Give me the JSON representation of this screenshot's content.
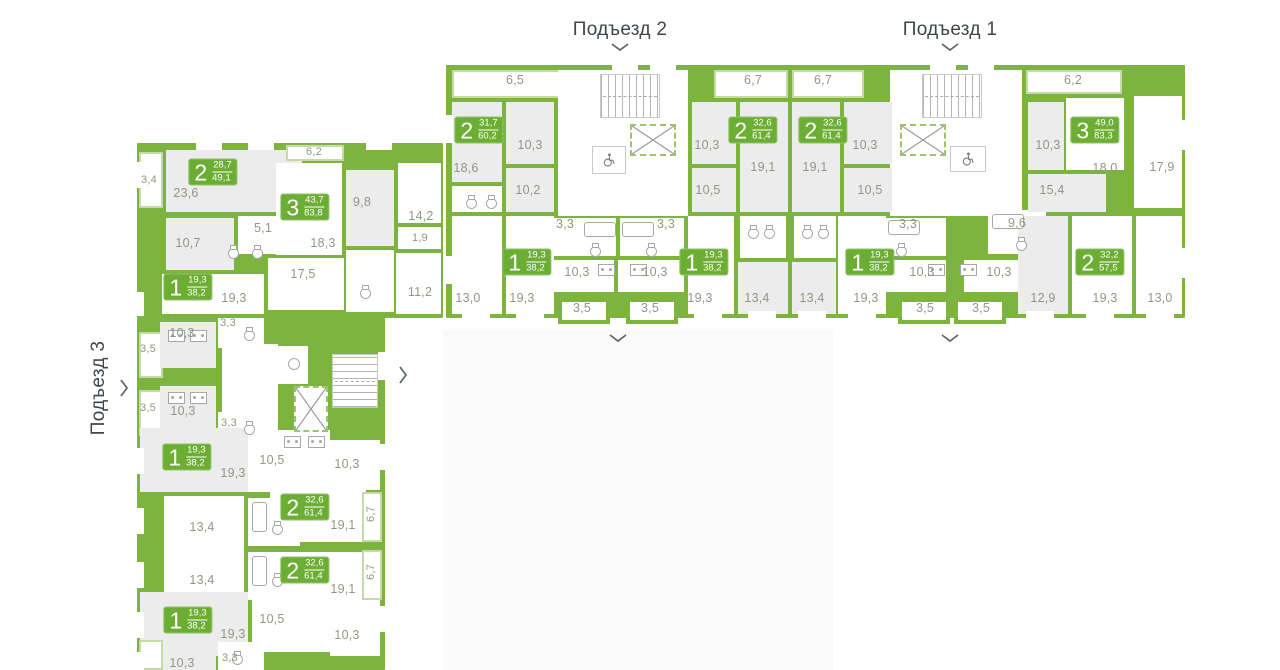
{
  "title": "Floor plan with entrances",
  "colors": {
    "wall": "#7db440",
    "badge": "#6cae34",
    "room_gray": "#ececec",
    "room_white": "#ffffff",
    "balcony_border": "#c6daa5",
    "area_label": "#8f9884",
    "entrance_label": "#3f474a"
  },
  "entrances": [
    {
      "label": "Подъезд 2",
      "x": 620,
      "y": 30,
      "rotated": false,
      "chevrons": [
        {
          "x": 620,
          "y": 47,
          "dir": "down"
        },
        {
          "x": 618,
          "y": 338,
          "dir": "down"
        }
      ]
    },
    {
      "label": "Подъезд 1",
      "x": 950,
      "y": 30,
      "rotated": false,
      "chevrons": [
        {
          "x": 950,
          "y": 47,
          "dir": "down"
        },
        {
          "x": 950,
          "y": 338,
          "dir": "down"
        }
      ]
    },
    {
      "label": "Подъезд 3",
      "x": 99,
      "y": 388,
      "rotated": true,
      "chevrons": [
        {
          "x": 124,
          "y": 388,
          "dir": "right"
        },
        {
          "x": 403,
          "y": 375,
          "dir": "right"
        }
      ]
    }
  ],
  "apartment_badges": [
    {
      "rooms": "2",
      "living": "31,7",
      "total": "60,2",
      "x": 479,
      "y": 130
    },
    {
      "rooms": "1",
      "living": "19,3",
      "total": "38,2",
      "x": 527,
      "y": 262
    },
    {
      "rooms": "1",
      "living": "19,3",
      "total": "38,2",
      "x": 704,
      "y": 262
    },
    {
      "rooms": "2",
      "living": "32,6",
      "total": "61,4",
      "x": 753,
      "y": 130
    },
    {
      "rooms": "2",
      "living": "32,6",
      "total": "61,4",
      "x": 823,
      "y": 130
    },
    {
      "rooms": "1",
      "living": "19,3",
      "total": "38,2",
      "x": 870,
      "y": 262
    },
    {
      "rooms": "3",
      "living": "49,0",
      "total": "83,3",
      "x": 1095,
      "y": 130
    },
    {
      "rooms": "2",
      "living": "32,2",
      "total": "57,5",
      "x": 1100,
      "y": 262
    },
    {
      "rooms": "2",
      "living": "28,7",
      "total": "49,1",
      "x": 213,
      "y": 172
    },
    {
      "rooms": "3",
      "living": "43,7",
      "total": "83,8",
      "x": 305,
      "y": 207
    },
    {
      "rooms": "1",
      "living": "19,3",
      "total": "38,2",
      "x": 188,
      "y": 287
    },
    {
      "rooms": "1",
      "living": "19,3",
      "total": "38,2",
      "x": 187,
      "y": 457
    },
    {
      "rooms": "2",
      "living": "32,6",
      "total": "61,4",
      "x": 305,
      "y": 507
    },
    {
      "rooms": "2",
      "living": "32,6",
      "total": "61,4",
      "x": 305,
      "y": 570
    },
    {
      "rooms": "1",
      "living": "19,3",
      "total": "38,2",
      "x": 188,
      "y": 620
    }
  ],
  "area_labels": [
    {
      "text": "6,5",
      "x": 515,
      "y": 80
    },
    {
      "text": "6,7",
      "x": 753,
      "y": 80
    },
    {
      "text": "6,7",
      "x": 823,
      "y": 80
    },
    {
      "text": "6,2",
      "x": 1073,
      "y": 80
    },
    {
      "text": "18,6",
      "x": 466,
      "y": 168
    },
    {
      "text": "10,3",
      "x": 530,
      "y": 145
    },
    {
      "text": "10,2",
      "x": 528,
      "y": 190
    },
    {
      "text": "10,3",
      "x": 707,
      "y": 145
    },
    {
      "text": "10,5",
      "x": 708,
      "y": 190
    },
    {
      "text": "19,1",
      "x": 763,
      "y": 167
    },
    {
      "text": "19,1",
      "x": 815,
      "y": 167
    },
    {
      "text": "3,3",
      "x": 565,
      "y": 224
    },
    {
      "text": "3,3",
      "x": 666,
      "y": 224
    },
    {
      "text": "10,3",
      "x": 577,
      "y": 272
    },
    {
      "text": "10,3",
      "x": 655,
      "y": 272
    },
    {
      "text": "13,0",
      "x": 468,
      "y": 298
    },
    {
      "text": "19,3",
      "x": 522,
      "y": 298
    },
    {
      "text": "3,5",
      "x": 582,
      "y": 308
    },
    {
      "text": "3,5",
      "x": 650,
      "y": 308
    },
    {
      "text": "19,3",
      "x": 700,
      "y": 298
    },
    {
      "text": "13,4",
      "x": 757,
      "y": 298
    },
    {
      "text": "13,4",
      "x": 812,
      "y": 298
    },
    {
      "text": "10,3",
      "x": 865,
      "y": 145
    },
    {
      "text": "10,5",
      "x": 870,
      "y": 190
    },
    {
      "text": "3,3",
      "x": 908,
      "y": 224
    },
    {
      "text": "9,6",
      "x": 1017,
      "y": 223
    },
    {
      "text": "10,3",
      "x": 922,
      "y": 272
    },
    {
      "text": "10,3",
      "x": 999,
      "y": 272
    },
    {
      "text": "19,3",
      "x": 866,
      "y": 298
    },
    {
      "text": "3,5",
      "x": 925,
      "y": 308
    },
    {
      "text": "3,5",
      "x": 981,
      "y": 308
    },
    {
      "text": "12,9",
      "x": 1043,
      "y": 298
    },
    {
      "text": "19,3",
      "x": 1105,
      "y": 298
    },
    {
      "text": "13,0",
      "x": 1160,
      "y": 298
    },
    {
      "text": "10,3",
      "x": 1048,
      "y": 145
    },
    {
      "text": "15,4",
      "x": 1052,
      "y": 190
    },
    {
      "text": "18,0",
      "x": 1105,
      "y": 168
    },
    {
      "text": "17,9",
      "x": 1162,
      "y": 167
    },
    {
      "text": "3,4",
      "x": 149,
      "y": 180,
      "small": true
    },
    {
      "text": "23,6",
      "x": 186,
      "y": 193
    },
    {
      "text": "6,2",
      "x": 314,
      "y": 152,
      "small": true
    },
    {
      "text": "9,8",
      "x": 362,
      "y": 202
    },
    {
      "text": "14,2",
      "x": 421,
      "y": 216
    },
    {
      "text": "1,9",
      "x": 420,
      "y": 238,
      "small": true
    },
    {
      "text": "5,1",
      "x": 263,
      "y": 228
    },
    {
      "text": "10,7",
      "x": 188,
      "y": 243
    },
    {
      "text": "18,3",
      "x": 323,
      "y": 243
    },
    {
      "text": "17,5",
      "x": 303,
      "y": 274
    },
    {
      "text": "11,2",
      "x": 420,
      "y": 292
    },
    {
      "text": "19,3",
      "x": 234,
      "y": 298
    },
    {
      "text": "3,3",
      "x": 228,
      "y": 323,
      "small": true
    },
    {
      "text": "10,3",
      "x": 182,
      "y": 333
    },
    {
      "text": "3,5",
      "x": 148,
      "y": 349,
      "small": true
    },
    {
      "text": "3,5",
      "x": 148,
      "y": 408,
      "small": true
    },
    {
      "text": "10,3",
      "x": 183,
      "y": 411
    },
    {
      "text": "3,3",
      "x": 229,
      "y": 423,
      "small": true
    },
    {
      "text": "19,3",
      "x": 233,
      "y": 473
    },
    {
      "text": "10,5",
      "x": 272,
      "y": 460
    },
    {
      "text": "10,3",
      "x": 347,
      "y": 464
    },
    {
      "text": "13,4",
      "x": 202,
      "y": 527
    },
    {
      "text": "19,1",
      "x": 343,
      "y": 525
    },
    {
      "text": "6,7",
      "x": 371,
      "y": 514,
      "rot": true,
      "small": true
    },
    {
      "text": "13,4",
      "x": 202,
      "y": 580
    },
    {
      "text": "19,1",
      "x": 343,
      "y": 589
    },
    {
      "text": "6,7",
      "x": 371,
      "y": 572,
      "rot": true,
      "small": true
    },
    {
      "text": "19,3",
      "x": 233,
      "y": 634
    },
    {
      "text": "10,5",
      "x": 272,
      "y": 619
    },
    {
      "text": "10,3",
      "x": 347,
      "y": 635
    },
    {
      "text": "10,3",
      "x": 182,
      "y": 663
    },
    {
      "text": "3,3",
      "x": 230,
      "y": 658,
      "small": true
    }
  ]
}
